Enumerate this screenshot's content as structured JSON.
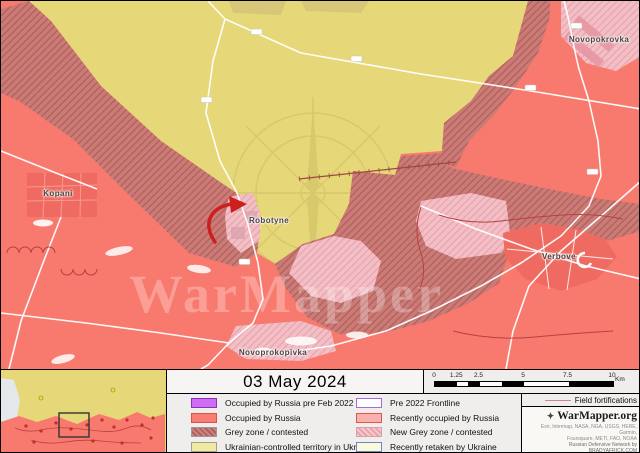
{
  "header": {
    "date": "03 May 2024"
  },
  "map": {
    "towns": [
      {
        "name": "Kopani"
      },
      {
        "name": "Robotyne"
      },
      {
        "name": "Novoprokopivka"
      },
      {
        "name": "Verbove"
      },
      {
        "name": "Novopokrovka"
      }
    ],
    "watermark": "WarMapper",
    "colors": {
      "ukrainian_controlled": "#e6d878",
      "occupied_by_russia": "#f8796e",
      "grey_zone_base": "#cb7b76",
      "grey_zone_hatch": "#ad5c5a",
      "new_grey_zone_base": "#f2bfc6",
      "new_grey_zone_hatch": "#e9a0aa",
      "occupied_pre_feb_2022": "#cf6ef2",
      "pre_2022_frontline": "#a86ad6",
      "recently_retaken_border": "#6b86cf",
      "field_fortification_line": "#c04545",
      "road": "#ffffff"
    }
  },
  "legend": {
    "left": [
      {
        "label": "Occupied by Russia pre Feb 2022"
      },
      {
        "label": "Occupied by Russia"
      },
      {
        "label": "Grey zone / contested"
      },
      {
        "label": "Ukrainian-controlled territory in Ukraine"
      }
    ],
    "right": [
      {
        "label": "Pre 2022 Frontline"
      },
      {
        "label": "Recently occupied by Russia"
      },
      {
        "label": "New Grey zone / contested"
      },
      {
        "label": "Recently retaken by Ukraine"
      }
    ]
  },
  "scalebar": {
    "ticks": [
      "0",
      "1.25",
      "2.5",
      "5",
      "7.5",
      "10"
    ],
    "unit": "Km"
  },
  "fortifications_label": "Field fortifications",
  "attribution": {
    "brand": "WarMapper.org",
    "credits": [
      "Esri, Intermap, NASA, NGA, USGS, HERE, Garmin,",
      "Foursquare, METI, FAO, NOAA",
      "Russian Defensive Network by BRADYAFRICK.COM"
    ]
  }
}
